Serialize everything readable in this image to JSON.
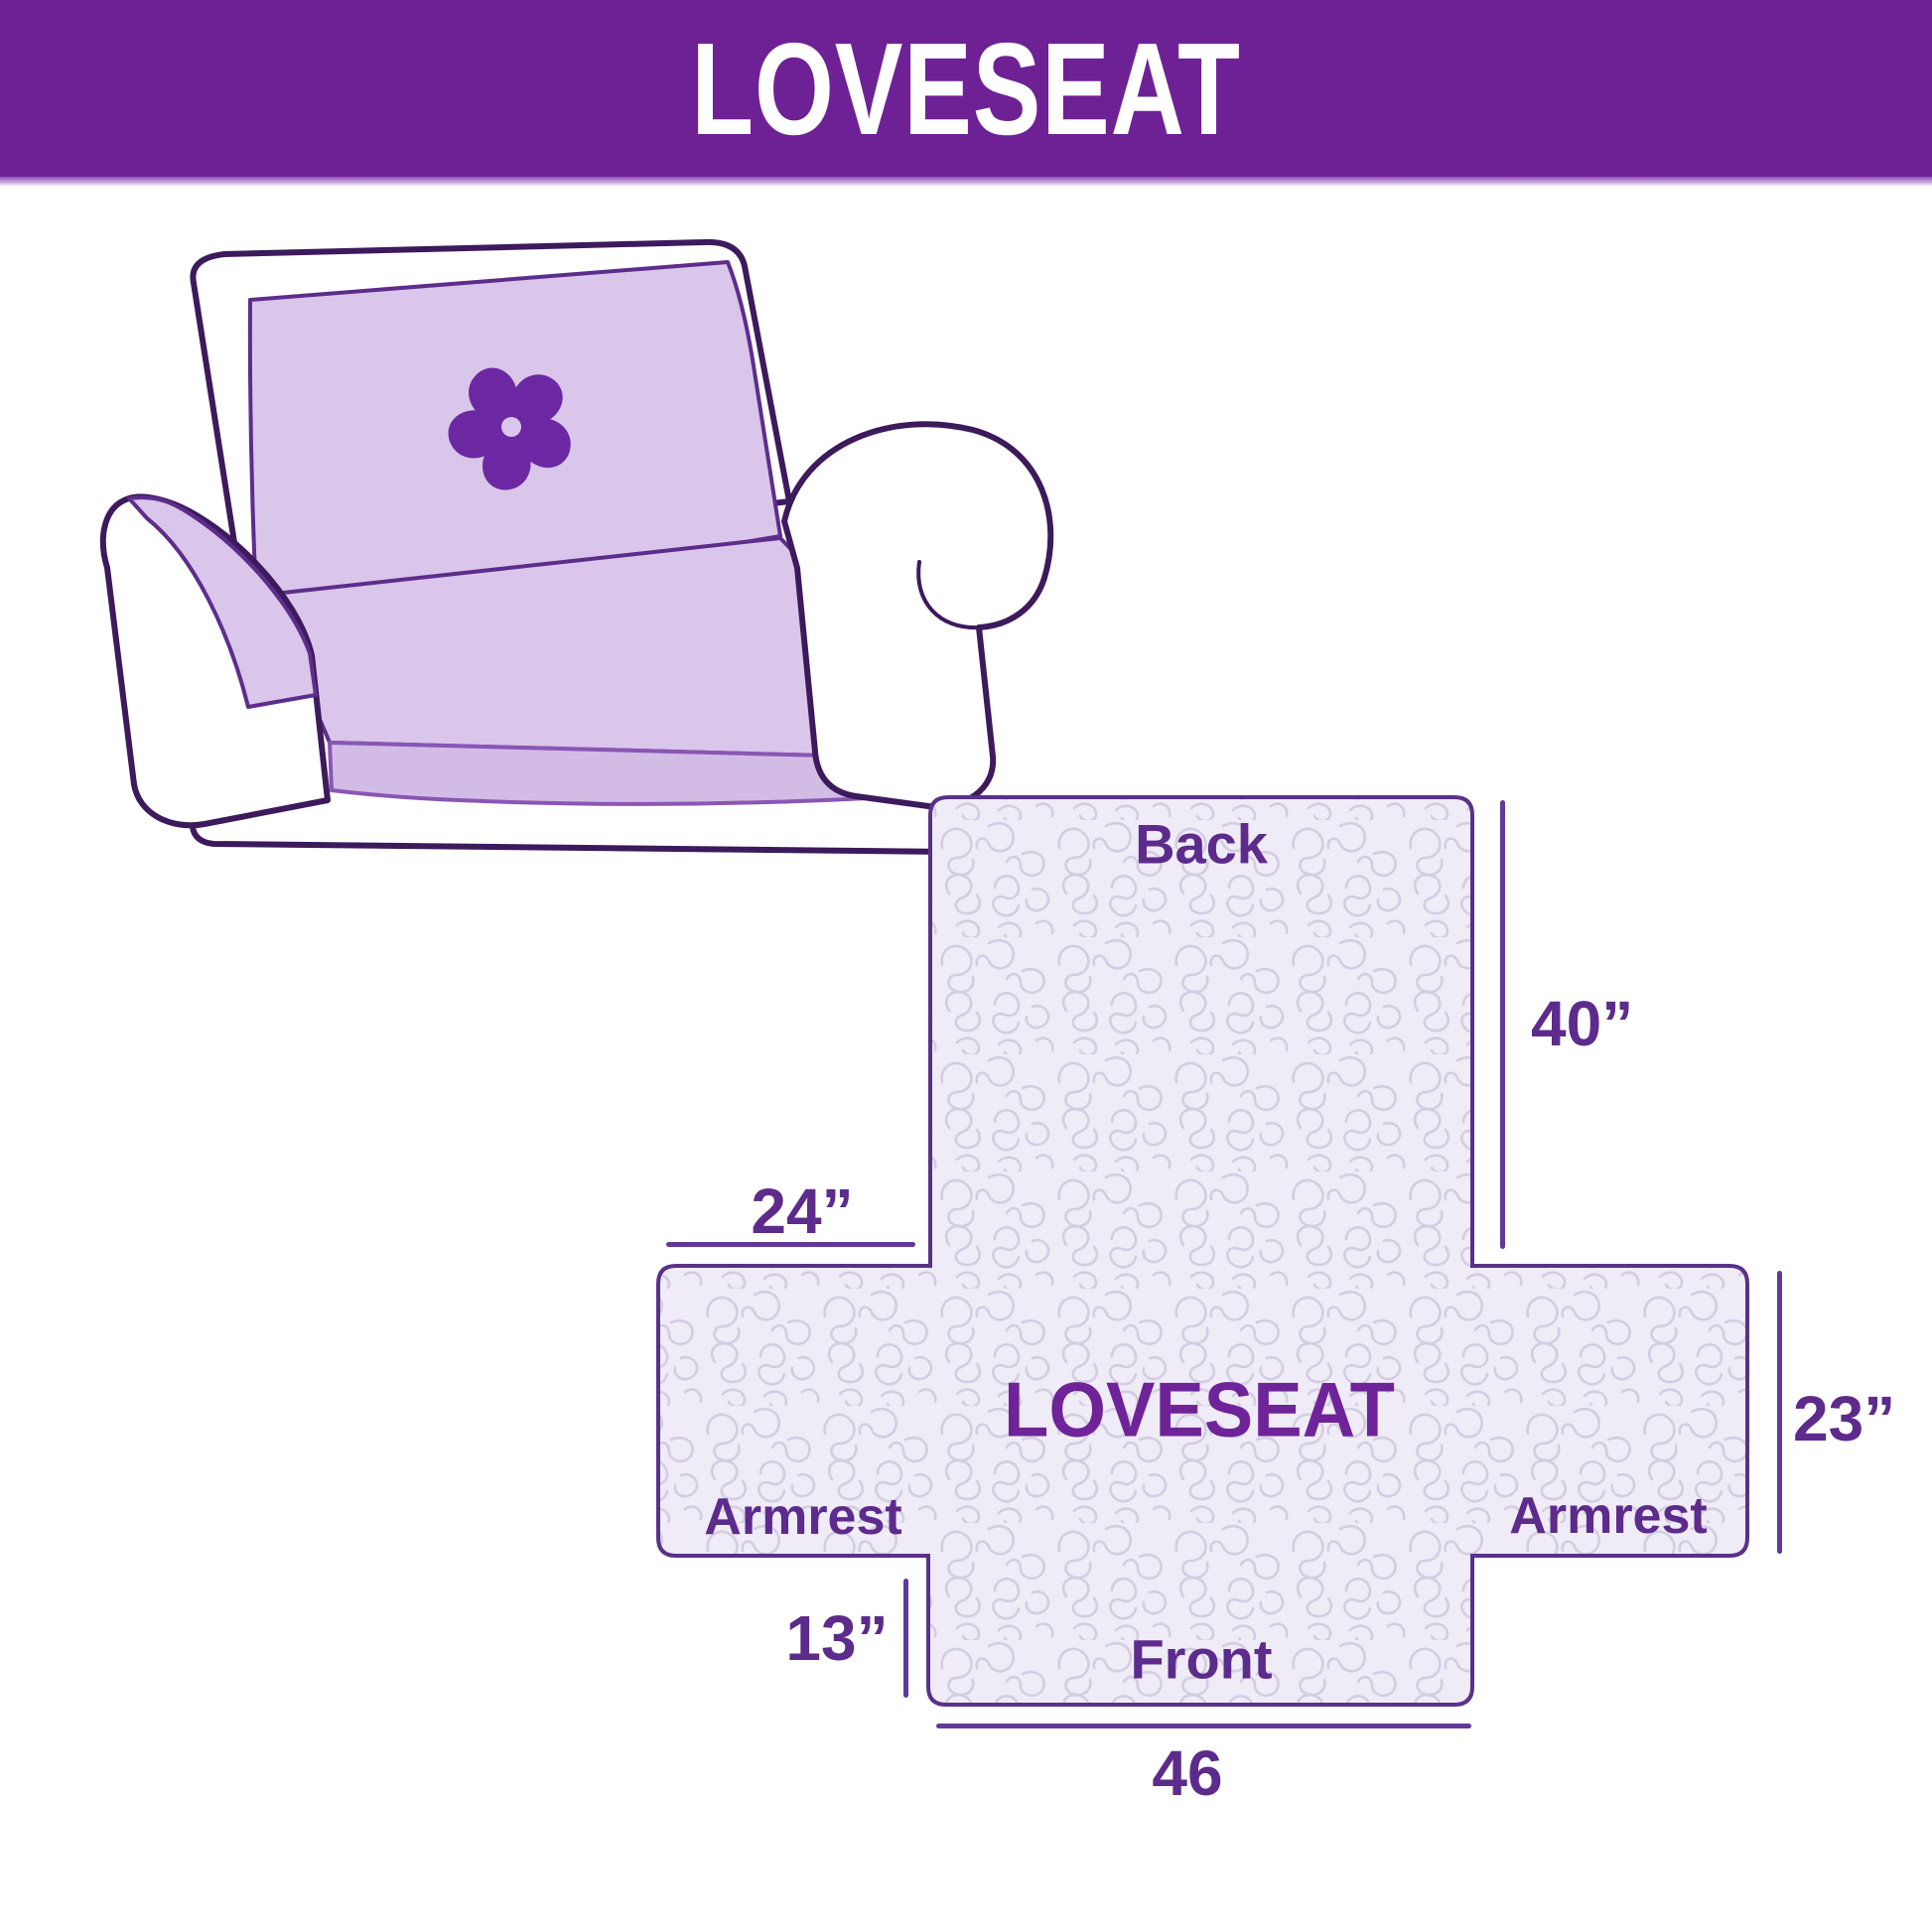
{
  "banner": {
    "title": "LOVESEAT",
    "bg_color": "#6e2195",
    "text_color": "#ffffff"
  },
  "illustration": {
    "alt": "loveseat sofa sketch with quilted slipcover",
    "cover_color": "#d9c6ea",
    "outline_color": "#3c1a5c",
    "logo_icon": "pinwheel-flower",
    "logo_color": "#6b28a2"
  },
  "diagram": {
    "labels": {
      "back": "Back",
      "front": "Front",
      "armrest_left": "Armrest",
      "armrest_right": "Armrest",
      "center": "LOVESEAT"
    },
    "dimensions": {
      "back_height": "40”",
      "back_top_width": "24”",
      "armrest_height": "23”",
      "front_skirt_height": "13”",
      "front_width": "46"
    },
    "fill_color": "#efebf7",
    "texture_color": "#d4cde1",
    "border_color": "#5a3189",
    "dimension_line_color": "#63389b"
  }
}
